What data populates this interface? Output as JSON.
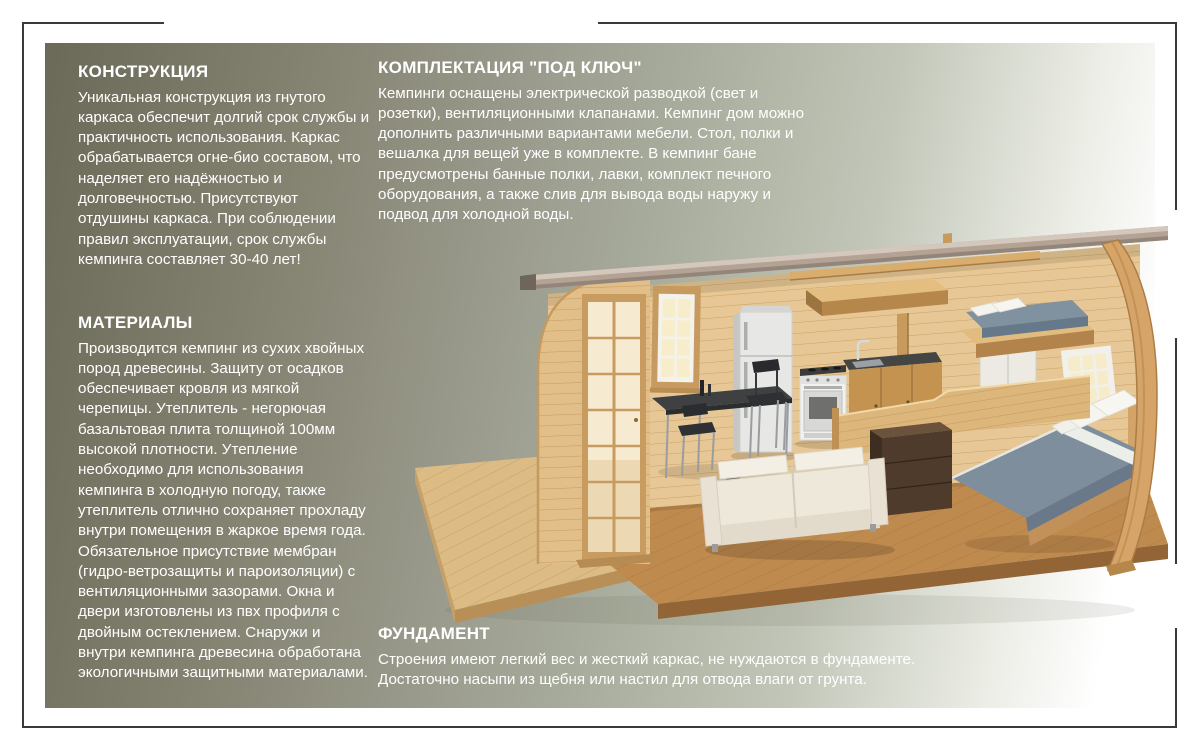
{
  "page": {
    "background": "#ffffff",
    "frame_color": "#3b3b35",
    "text_color": "#ffffff",
    "panel_gradient": [
      "#6b6957",
      "#82806e",
      "#98988a",
      "#a9ae9e",
      "#c2c6b8",
      "#e9ebe3",
      "#ffffff"
    ]
  },
  "sections": {
    "construction": {
      "title": "КОНСТРУКЦИЯ",
      "body": "Уникальная конструкция из гнутого каркаса обеспечит долгий срок службы и практичность использования. Каркас обрабатывается огне-био составом, что наделяет его надёжностью и долговечностью. Присутствуют отдушины каркаса. При соблюдении правил эксплуатации, срок службы кемпинга составляет 30-40 лет!"
    },
    "materials": {
      "title": "МАТЕРИАЛЫ",
      "body": "Производится кемпинг из сухих хвойных пород древесины. Защиту от осадков обеспечивает кровля из мягкой черепицы.  Утеплитель - негорючая базальтовая плита толщиной 100мм высокой плотности. Утепление необходимо для использования кемпинга в холодную погоду, также утеплитель отлично сохраняет прохладу внутри помещения в жаркое время года. Обязательное присутствие мембран (гидро-ветрозащиты и пароизоляции) с вентиляционными зазорами. Окна и двери изготовлены из пвх профиля с двойным остеклением. Снаружи и внутри кемпинга древесина обработана экологичными  защитными материалами."
    },
    "turnkey": {
      "title": "КОМПЛЕКТАЦИЯ \"ПОД КЛЮЧ\"",
      "body": "Кемпинги оснащены электрической разводкой (свет и розетки), вентиляционными клапанами. Кемпинг дом можно дополнить различными вариантами мебели. Стол, полки и вешалка для вещей уже в комплекте. В кемпинг бане предусмотрены банные полки, лавки, комплект печного оборудования, а также слив для вывода воды наружу и подвод для холодной воды."
    },
    "foundation": {
      "title": "ФУНДАМЕНТ",
      "body": "Строения имеют легкий вес и жесткий каркас, не нуждаются в фундаменте. Достаточно насыпи из щебня или настил для отвода влаги от грунта."
    }
  },
  "illustration": {
    "name": "camping-house-cutaway-render",
    "parts": [
      "curved-wood-arch-frame",
      "roof-panel",
      "plank-back-wall",
      "glass-french-door",
      "window-left",
      "window-right",
      "loft-shelf",
      "loft-platform",
      "bunk-bed",
      "double-bed",
      "white-sofa",
      "media-cabinet",
      "kitchen-fridge",
      "kitchen-stove",
      "kitchen-counter-sink",
      "dining-table",
      "chairs",
      "wood-deck",
      "interior-floor"
    ],
    "colors": {
      "wall_wood": "#e6c795",
      "floor_wood": "#bf8a4e",
      "deck_wood": "#dcbb85",
      "roof": "#b4a395",
      "arch_wood": "#d6a468",
      "mattress": "#7e8e9c",
      "sofa": "#eee8db",
      "counter": "#454644",
      "appliance_white": "#f1f1ef"
    }
  }
}
